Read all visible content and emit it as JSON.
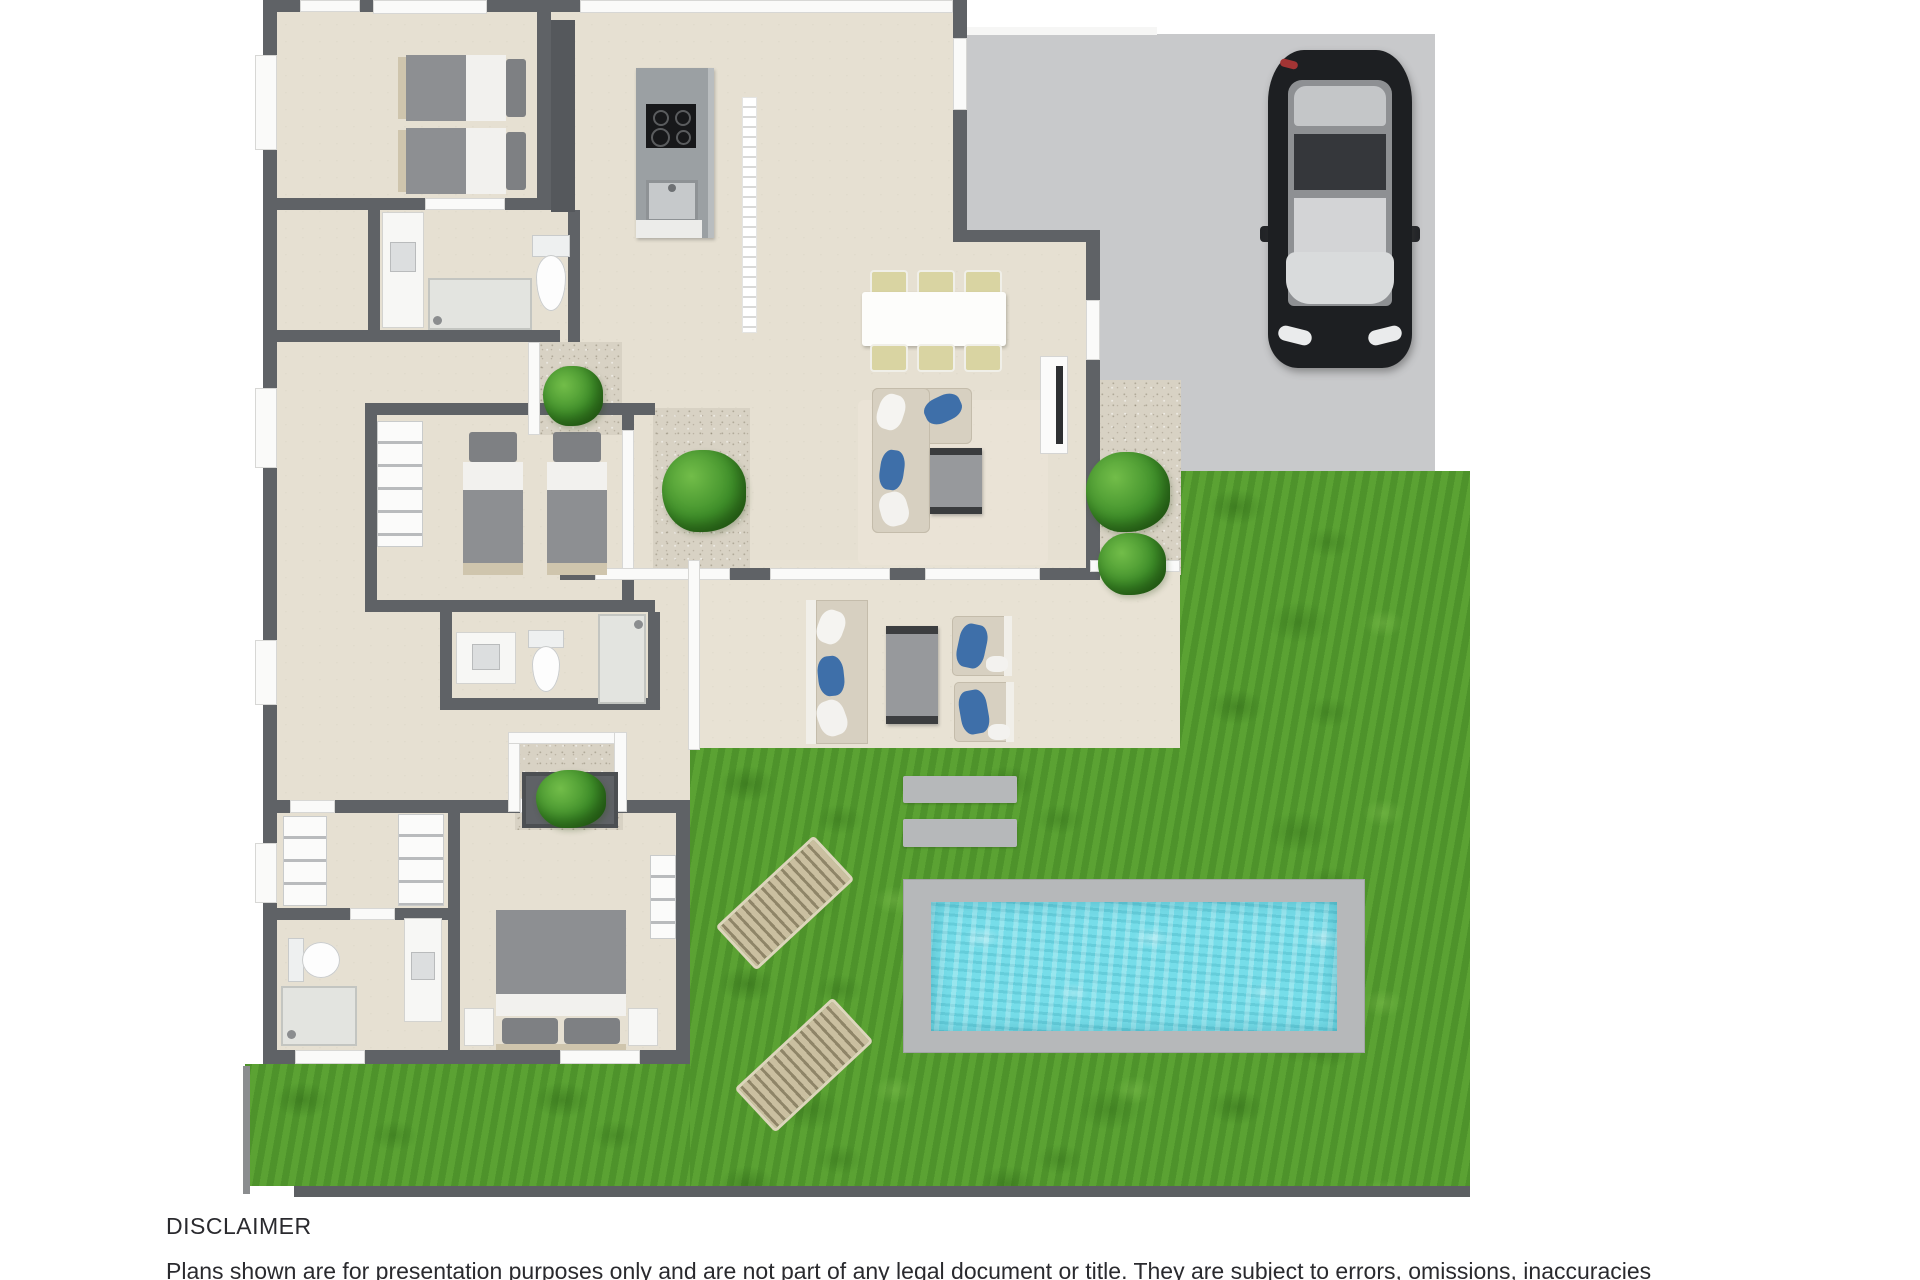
{
  "page": {
    "width": 1920,
    "height": 1280,
    "background": "#ffffff"
  },
  "disclaimer": {
    "title": "DISCLAIMER",
    "body": "Plans shown are for presentation purposes only and are not part of any legal document or title. They are subject to errors, omissions, inaccuracies"
  },
  "colors": {
    "wall": "#5f6266",
    "floor": "#e6e0d2",
    "alfresco": "#e8e2d4",
    "lawn": "#569e30",
    "lawn_dark": "#47892a",
    "driveway": "#c8c9cb",
    "gravel": "#d8d2c4",
    "pool_coping": "#b6b8ba",
    "pool_water": "#76dde9",
    "bush": "#3f8f2a",
    "bush_light": "#72bd49",
    "car_body": "#1d1f22",
    "bed_blanket": "#8d8f92",
    "bed_pillow": "#7e8083",
    "bed_sheet": "#f2f1ee",
    "bed_base": "#cfc5ad",
    "sofa": "#d7d0c1",
    "cushion_blue": "#3e6fa9",
    "table_gray": "#97999c",
    "chair_seat": "#d9d4a2",
    "lounger": "#cabfa0",
    "lounger_gap": "#8f8568",
    "white_fixture": "#f7f7f5",
    "shadow": "#5c5f62",
    "text": "#2a2a2e"
  },
  "floorplan": {
    "description": "3D rendered residential floor plan, top-down view, no room labels",
    "rooms": [
      "twin-bedroom-top",
      "ensuite-bathroom-top",
      "kitchen",
      "entry-hall",
      "dining-area",
      "living-area",
      "twin-bedroom-middle",
      "central-bathroom",
      "hallway",
      "walk-in-robe",
      "master-bathroom",
      "master-bedroom",
      "alfresco-patio",
      "courtyard-gardens"
    ],
    "outdoor": [
      "driveway",
      "black-car",
      "lawn",
      "swimming-pool",
      "sun-loungers",
      "stepping-pads",
      "garden-bushes",
      "gravel-beds"
    ]
  }
}
